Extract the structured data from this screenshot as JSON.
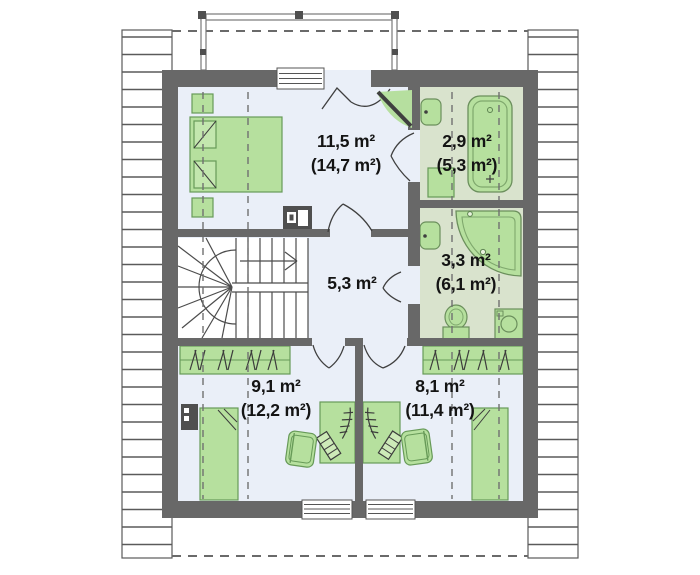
{
  "plan": {
    "kind": "attic-floor-plan",
    "colors": {
      "wall": "#686868",
      "room_floor": "#eaeff8",
      "bathroom_floor": "#d9e3cd",
      "furniture_fill": "#b6e09e",
      "furniture_outline": "#679a58",
      "line": "#4c4c4c"
    }
  },
  "rooms": [
    {
      "id": "bedroom",
      "area": "11,5 m²",
      "total_area": "(14,7 m²)",
      "furniture": [
        "double-bed",
        "nightstand",
        "nightstand",
        "dresser"
      ]
    },
    {
      "id": "bathroom-upper",
      "area": "2,9 m²",
      "total_area": "(5,3 m²)",
      "furniture": [
        "bathtub",
        "washbasin",
        "cabinet"
      ]
    },
    {
      "id": "bathroom-lower",
      "area": "3,3 m²",
      "total_area": "(6,1 m²)",
      "furniture": [
        "corner-bathtub",
        "washbasin",
        "toilet",
        "washing-machine"
      ]
    },
    {
      "id": "hall",
      "area": "5,3 m²",
      "furniture": [
        "winder-staircase"
      ]
    },
    {
      "id": "bedroom-left",
      "area": "9,1 m²",
      "total_area": "(12,2 m²)",
      "furniture": [
        "single-bed",
        "wardrobe",
        "desk",
        "desk-chair",
        "radiator"
      ]
    },
    {
      "id": "bedroom-right",
      "area": "8,1 m²",
      "total_area": "(11,4 m²)",
      "furniture": [
        "single-bed",
        "wardrobe",
        "desk",
        "desk-chair"
      ]
    }
  ]
}
